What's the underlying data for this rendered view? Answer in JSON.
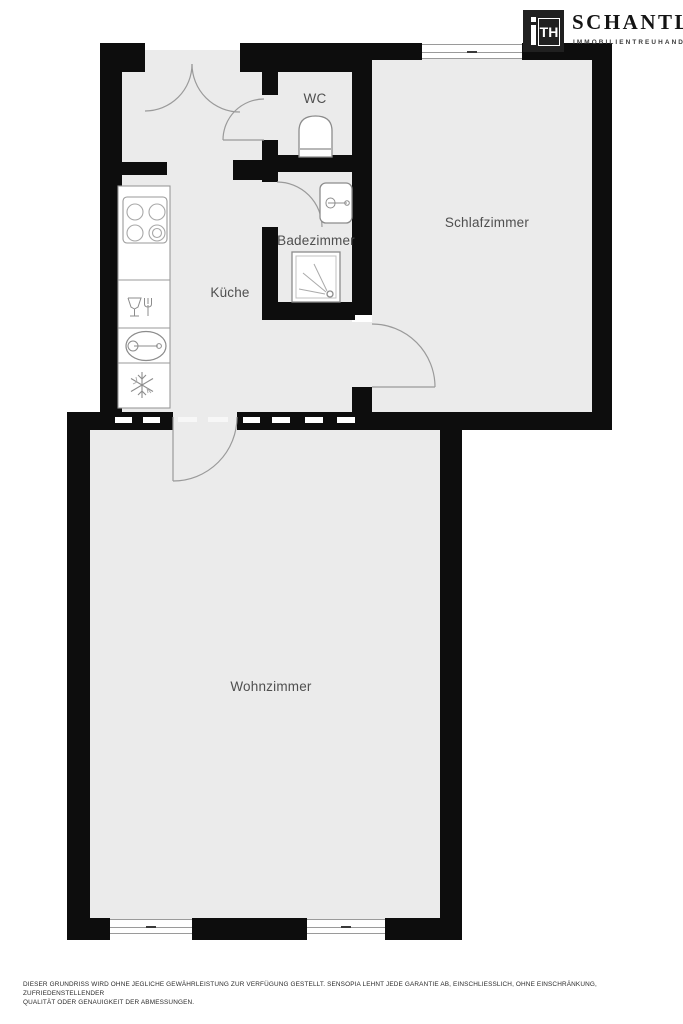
{
  "logo": {
    "monogram_i": "i",
    "monogram_th": "TH",
    "company": "SCHANTL",
    "tagline": "IMMOBILIENTREUHAND"
  },
  "rooms": {
    "wc": "WC",
    "schlafzimmer": "Schlafzimmer",
    "badezimmer": "Badezimmer",
    "kueche": "Küche",
    "wohnzimmer": "Wohnzimmer"
  },
  "icons": {
    "toilet": "toilet-icon",
    "washbasin": "washbasin-icon",
    "shower": "shower-icon",
    "stove": "stove-icon",
    "dishwasher": "dishwasher-icon",
    "sink": "sink-icon",
    "fridge": "fridge-snowflake-icon",
    "door": "door-swing-arc",
    "window": "window-symbol",
    "logo_monogram": "ith-monogram-icon"
  },
  "colors": {
    "wall": "#0d0d0d",
    "room_fill": "#ebebeb",
    "fixture_stroke": "#8c8c8c",
    "label_text": "#4f4f4f",
    "logo_background": "#202020"
  },
  "disclaimer": {
    "line1": "DIESER GRUNDRISS WIRD OHNE JEGLICHE GEWÄHRLEISTUNG ZUR VERFÜGUNG GESTELLT. SENSOPIA LEHNT JEDE GARANTIE AB, EINSCHLIESSLICH, OHNE EINSCHRÄNKUNG, ZUFRIEDENSTELLENDER",
    "line2": "QUALITÄT ODER GENAUIGKEIT DER ABMESSUNGEN."
  }
}
